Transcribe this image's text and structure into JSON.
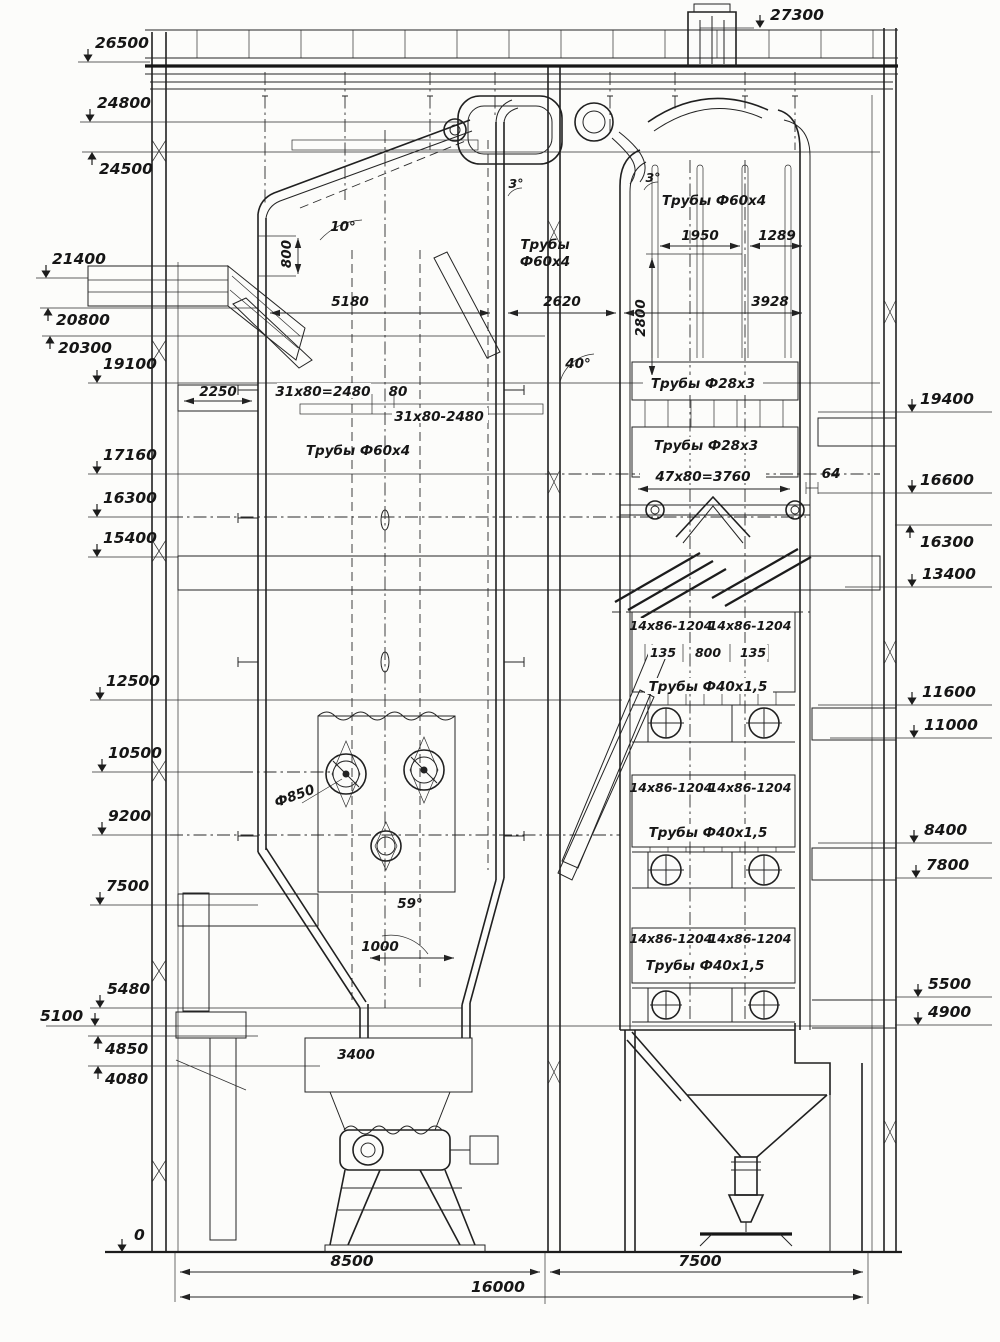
{
  "drawing": {
    "kind": "boiler-section-engineering-drawing",
    "ink_color": "#242424",
    "paper_color": "#fcfcfa"
  },
  "labels": {
    "top": "27300",
    "left": [
      "26500",
      "24800",
      "24500",
      "21400",
      "20800",
      "20300",
      "19100",
      "17160",
      "16300",
      "15400",
      "12500",
      "10500",
      "9200",
      "7500",
      "5480",
      "5100",
      "4850",
      "4080",
      "0"
    ],
    "right": [
      "19400",
      "16600",
      "16300",
      "13400",
      "11600",
      "11000",
      "8400",
      "7800",
      "5500",
      "4900"
    ],
    "bottom": [
      "8500",
      "7500",
      "16000"
    ]
  },
  "ann": {
    "angle_10": "10°",
    "dim_800v": "800",
    "dim_5180": "5180",
    "tubes_mid_1": "Трубы",
    "tubes_mid_2": "Ф60х4",
    "dim_2620": "2620",
    "dim_2800": "2800",
    "tubes_right_top": "Трубы Ф60х4",
    "dim_1950": "1950",
    "dim_1289": "1289",
    "dim_3928": "3928",
    "angle_3l": "3°",
    "angle_3r": "3°",
    "dim_2250": "2250",
    "pitch_a": "31х80=2480",
    "dim_80": "80",
    "pitch_b": "31х80-2480",
    "tubes_furnace": "Трубы Ф60х4",
    "angle_40": "40°",
    "tubes_28": "Трубы Ф28х3",
    "pitch_47": "47х80=3760",
    "dim_64": "64",
    "coil": "14х86-1204",
    "dim_135": "135",
    "dim_800c": "800",
    "tubes_40": "Трубы Ф40х1,5",
    "burner_dia": "Ф850",
    "angle_59": "59°",
    "dim_1000": "1000",
    "dim_3400": "3400"
  }
}
